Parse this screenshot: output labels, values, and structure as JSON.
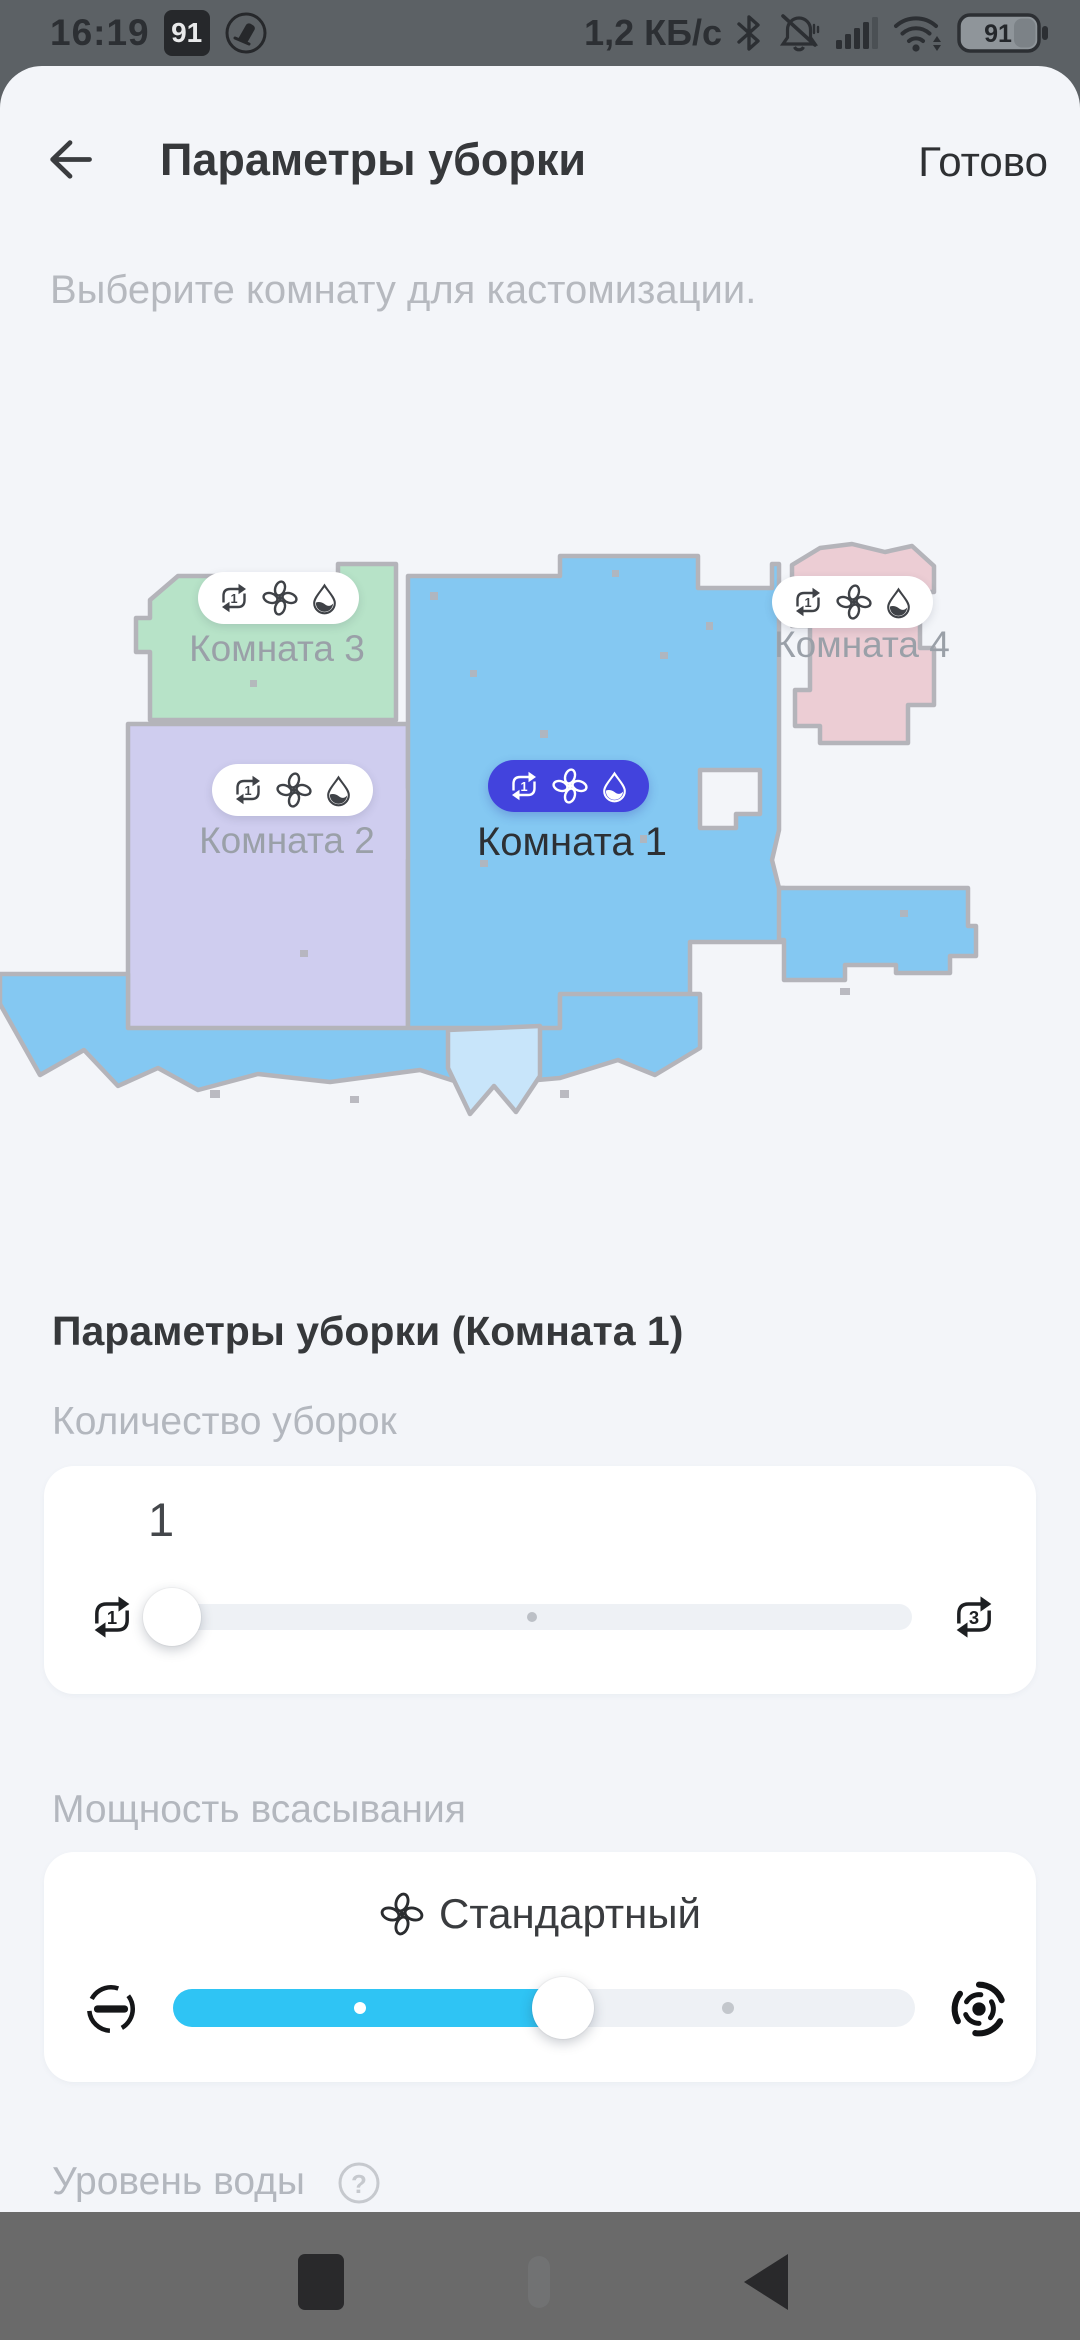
{
  "colors": {
    "accent_selected_pill": "#4243dd",
    "slider_fill": "#2fc4f4",
    "room1_fill": "#84c8f2",
    "room2_fill": "#cfcdef",
    "room3_fill": "#b7e3c8",
    "room4_fill": "#eccdd4",
    "sheet_bg": "#f3f5f9"
  },
  "status_bar": {
    "time": "16:19",
    "battery_widget_label": "91",
    "net_speed": "1,2 КБ/с",
    "battery_percent": "91"
  },
  "header": {
    "title": "Параметры уборки",
    "done_label": "Готово"
  },
  "intro_text": "Выберите комнату для кастомизации.",
  "map": {
    "rooms": [
      {
        "label": "Комната 1",
        "selected": true,
        "repeat_count": "1"
      },
      {
        "label": "Комната 2",
        "selected": false,
        "repeat_count": "1"
      },
      {
        "label": "Комната 3",
        "selected": false,
        "repeat_count": "1"
      },
      {
        "label": "Комната 4",
        "selected": false,
        "repeat_count": "1"
      }
    ]
  },
  "section_title": "Параметры уборки (Комната 1)",
  "cleaning_count": {
    "label": "Количество уборок",
    "value": "1",
    "min": "1",
    "max": "3"
  },
  "suction": {
    "label": "Мощность всасывания",
    "mode": "Стандартный",
    "level": 2,
    "levels": 4
  },
  "water_level": {
    "label": "Уровень воды"
  }
}
